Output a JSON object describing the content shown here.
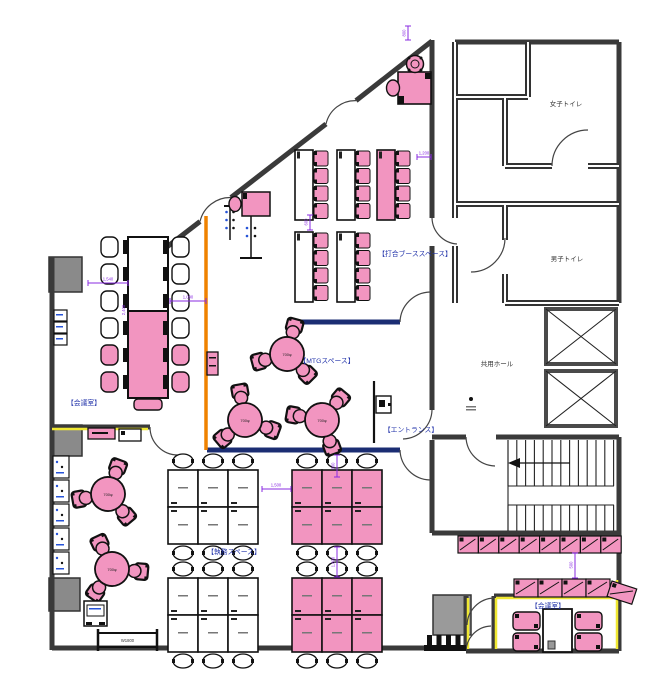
{
  "labels": {
    "meeting_room_left": "【会議室】",
    "mtg_space": "【MTGスペース】",
    "booth_space": "【打合ブーススペース】",
    "entrance": "【エントランス】",
    "work_space": "【執務スペース】",
    "meeting_room_right": "【会議室】",
    "womens_toilet": "女子トイレ",
    "mens_toilet": "男子トイレ",
    "elevator_hall": "共用ホール"
  },
  "dimensions": {
    "d1": "1,540",
    "d2": "1,090",
    "d3": "1,500",
    "d4": "1,200",
    "d5": "800",
    "d6": "1,800",
    "d7": "500",
    "d8": "800",
    "d9": "600",
    "d10": "2,400",
    "bench": "W1800",
    "table_dia": "700φ"
  },
  "colors": {
    "furniture_pink": "#f295c0",
    "wall_gray": "#3a3a3a",
    "partition_navy": "#1b2d73",
    "partition_orange": "#ef8200",
    "partition_yellow": "#f0e832",
    "dimension_purple": "#8a2be2",
    "label_blue": "#2233aa",
    "pillar_gray": "#8a8a8a"
  }
}
